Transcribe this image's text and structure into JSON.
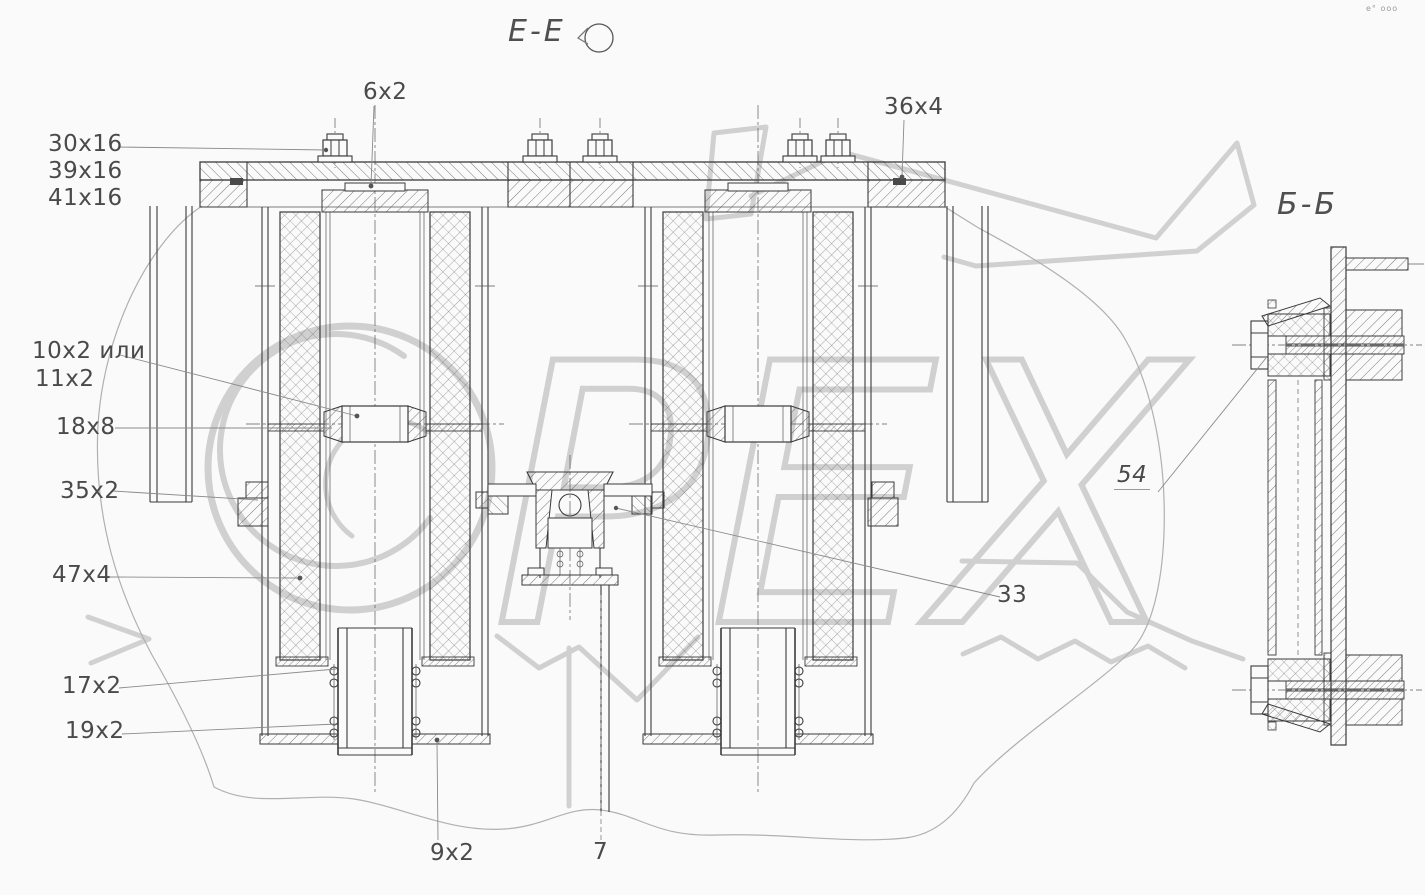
{
  "drawing": {
    "view_title": "Е-Е",
    "section_title": "Б-Б",
    "watermark": "ОРЕХ",
    "watermark_rest": "РЕХ",
    "corner_mark": "e° ooo"
  },
  "callouts": {
    "c30x16": "30х16",
    "c39x16": "39х16",
    "c41x16": "41х16",
    "c6x2": "6х2",
    "c36x4": "36х4",
    "c10x2": "10х2 или",
    "c11x2": "11х2",
    "c18x8": "18х8",
    "c35x2": "35х2",
    "c47x4": "47х4",
    "c17x2": "17х2",
    "c19x2": "19х2",
    "c9x2": "9х2",
    "c7": "7",
    "c33": "33",
    "c54": "54"
  }
}
